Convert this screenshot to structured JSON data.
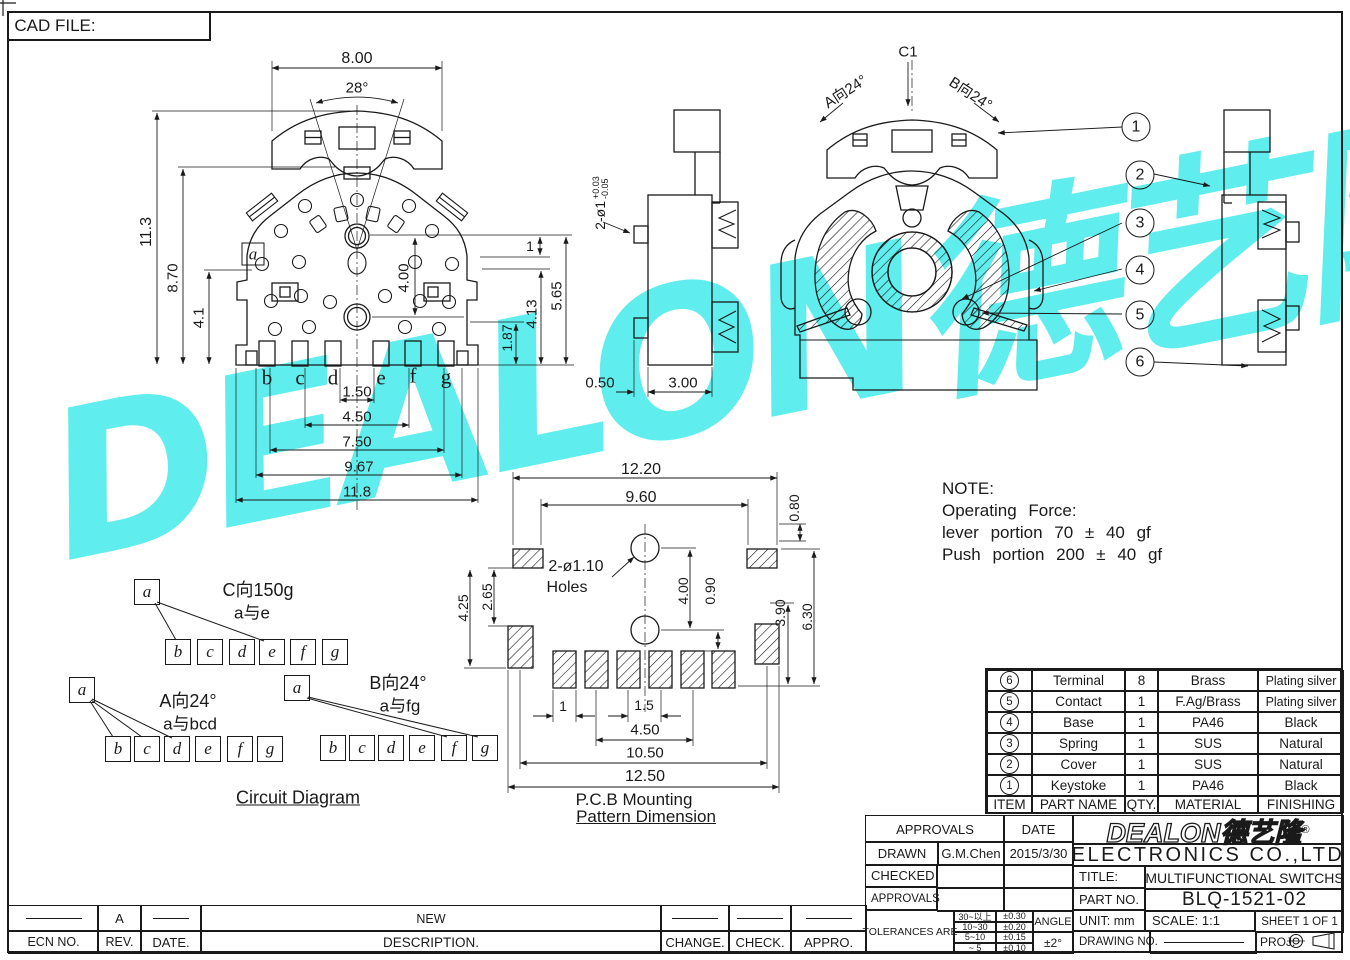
{
  "page": {
    "cad_file_label": "CAD FILE:"
  },
  "watermark": {
    "text": "DEALON德艺隆®",
    "color": "#5feded"
  },
  "front_view": {
    "dim_8_00": "8.00",
    "dim_28deg": "28°",
    "dim_11_3": "11.3",
    "dim_8_70": "8.70",
    "dim_4_1": "4.1",
    "dim_4_00": "4.00",
    "dim_1": "1",
    "dim_5_65": "5.65",
    "dim_4_13": "4.13",
    "dim_1_87": "1.87",
    "dim_1_50": "1.50",
    "dim_4_50": "4.50",
    "dim_7_50": "7.50",
    "dim_9_67": "9.67",
    "dim_11_8": "11.8",
    "marker_a": "a",
    "pins": [
      "b",
      "c",
      "d",
      "e",
      "f",
      "g"
    ]
  },
  "side_view": {
    "dim_hole": "2-ø1",
    "tol_plus": "+0.03",
    "tol_minus": "-0.05",
    "dim_0_50": "0.50",
    "dim_3_00": "3.00"
  },
  "section_view": {
    "label_c1": "C1",
    "label_a_dir": "A向24°",
    "label_b_dir": "B向24°",
    "balloons": [
      "1",
      "2",
      "3",
      "4",
      "5",
      "6"
    ]
  },
  "pcb": {
    "dim_12_20": "12.20",
    "dim_9_60": "9.60",
    "dim_0_80": "0.80",
    "holes_line1": "2-ø1.10",
    "holes_line2": "Holes",
    "dim_2_65": "2.65",
    "dim_4_25": "4.25",
    "dim_4_00": "4.00",
    "dim_0_90": "0.90",
    "dim_3_90": "3.90",
    "dim_6_30": "6.30",
    "dim_1": "1",
    "dim_1_5": "1.5",
    "dim_4_50": "4.50",
    "dim_10_50": "10.50",
    "dim_12_50": "12.50",
    "caption1": "P.C.B Mounting",
    "caption2": "Pattern Dimension"
  },
  "circuit": {
    "caption": "Circuit Diagram",
    "a_label": "a",
    "letters": [
      "b",
      "c",
      "d",
      "e",
      "f",
      "g"
    ],
    "group_c": {
      "line1": "C向150g",
      "line2": "a与e"
    },
    "group_a": {
      "line1": "A向24°",
      "line2": "a与bcd"
    },
    "group_b": {
      "line1": "B向24°",
      "line2": "a与fg"
    }
  },
  "note": {
    "l1": "NOTE:",
    "l2": "Operating Force:",
    "l3": "lever portion 70 ± 40 gf",
    "l4": "Push portion 200 ± 40 gf"
  },
  "parts_table": {
    "header": {
      "item": "ITEM",
      "part_name": "PART NAME",
      "qty": "QTY.",
      "material": "MATERIAL",
      "finishing": "FINISHING"
    },
    "rows": [
      {
        "item": "6",
        "part_name": "Terminal",
        "qty": "8",
        "material": "Brass",
        "finishing": "Plating silver"
      },
      {
        "item": "5",
        "part_name": "Contact",
        "qty": "1",
        "material": "F.Ag/Brass",
        "finishing": "Plating silver"
      },
      {
        "item": "4",
        "part_name": "Base",
        "qty": "1",
        "material": "PA46",
        "finishing": "Black"
      },
      {
        "item": "3",
        "part_name": "Spring",
        "qty": "1",
        "material": "SUS",
        "finishing": "Natural"
      },
      {
        "item": "2",
        "part_name": "Cover",
        "qty": "1",
        "material": "SUS",
        "finishing": "Natural"
      },
      {
        "item": "1",
        "part_name": "Keystoke",
        "qty": "1",
        "material": "PA46",
        "finishing": "Black"
      }
    ]
  },
  "title_block": {
    "approvals_header": "APPROVALS",
    "date_header": "DATE",
    "drawn_label": "DRAWN",
    "drawn_name": "G.M.Chen",
    "drawn_date": "2015/3/30",
    "checked_label": "CHECKED",
    "approvals_label": "APPROVALS",
    "tolerances_label": "TOLERANCES ARE",
    "tol_rows": [
      {
        "range": "30~以上",
        "tol": "±0.30"
      },
      {
        "range": "10~30",
        "tol": "±0.20"
      },
      {
        "range": "5~10",
        "tol": "±0.15"
      },
      {
        "range": "~ 5",
        "tol": "±0.10"
      }
    ],
    "angle_label": "ANGLE",
    "angle_tol": "±2°",
    "logo_text": "DEALON德艺隆",
    "logo_reg": "®",
    "company": "ELECTRONICS CO.,LTD",
    "title_label": "TITLE:",
    "title_value": "MULTIFUNCTIONAL SWITCHS",
    "part_no_label": "PART NO.",
    "part_no_value": "BLQ-1521-02",
    "unit": "UNIT: mm",
    "scale": "SCALE: 1:1",
    "sheet": "SHEET 1 OF 1",
    "drawing_no_label": "DRAWING NO.",
    "proj_label": "PROJ:"
  },
  "revision_strip": {
    "headers": [
      "ECN NO.",
      "REV.",
      "DATE.",
      "DESCRIPTION.",
      "CHANGE.",
      "CHECK.",
      "APPRO."
    ],
    "row": {
      "rev": "A",
      "description": "NEW"
    }
  }
}
